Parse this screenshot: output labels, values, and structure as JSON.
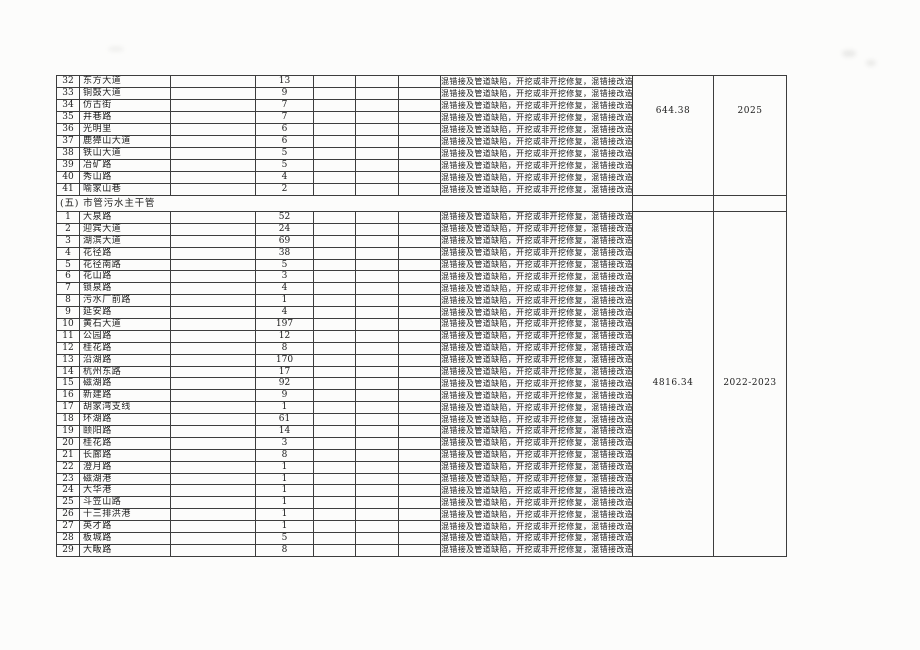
{
  "document": {
    "defect_text": "混错接及管道缺陷，开挖或非开挖修复，混错接改造",
    "sections": [
      {
        "id": "continuation-section",
        "header": null,
        "amount": "644.38",
        "years": "2025",
        "rows": [
          {
            "no": "32",
            "name": "东方大道",
            "qty": "13"
          },
          {
            "no": "33",
            "name": "铜鼓大道",
            "qty": "9"
          },
          {
            "no": "34",
            "name": "仿古街",
            "qty": "7"
          },
          {
            "no": "35",
            "name": "井巷路",
            "qty": "7"
          },
          {
            "no": "36",
            "name": "光明里",
            "qty": "6"
          },
          {
            "no": "37",
            "name": "鹿獐山大道",
            "qty": "6"
          },
          {
            "no": "38",
            "name": "铁山大道",
            "qty": "5"
          },
          {
            "no": "39",
            "name": "冶矿路",
            "qty": "5"
          },
          {
            "no": "40",
            "name": "秀山路",
            "qty": "4"
          },
          {
            "no": "41",
            "name": "喻家山巷",
            "qty": "2"
          }
        ]
      },
      {
        "id": "section-5",
        "header": "(五) 市管污水主干管",
        "amount": "4816.34",
        "years": "2022-2023",
        "rows": [
          {
            "no": "1",
            "name": "大泉路",
            "qty": "52"
          },
          {
            "no": "2",
            "name": "迎宾大道",
            "qty": "24"
          },
          {
            "no": "3",
            "name": "湖滨大道",
            "qty": "69"
          },
          {
            "no": "4",
            "name": "花径路",
            "qty": "38"
          },
          {
            "no": "5",
            "name": "花径南路",
            "qty": "5"
          },
          {
            "no": "6",
            "name": "花山路",
            "qty": "3"
          },
          {
            "no": "7",
            "name": "锁泉路",
            "qty": "4"
          },
          {
            "no": "8",
            "name": "污水厂前路",
            "qty": "1"
          },
          {
            "no": "9",
            "name": "延安路",
            "qty": "4"
          },
          {
            "no": "10",
            "name": "黄石大道",
            "qty": "197"
          },
          {
            "no": "11",
            "name": "公园路",
            "qty": "12"
          },
          {
            "no": "12",
            "name": "桂花路",
            "qty": "8"
          },
          {
            "no": "13",
            "name": "沿湖路",
            "qty": "170"
          },
          {
            "no": "14",
            "name": "杭州东路",
            "qty": "17"
          },
          {
            "no": "15",
            "name": "磁湖路",
            "qty": "92"
          },
          {
            "no": "16",
            "name": "新建路",
            "qty": "9"
          },
          {
            "no": "17",
            "name": "胡家湾支线",
            "qty": "1"
          },
          {
            "no": "18",
            "name": "环湖路",
            "qty": "61"
          },
          {
            "no": "19",
            "name": "颐阳路",
            "qty": "14"
          },
          {
            "no": "20",
            "name": "桂花路",
            "qty": "3"
          },
          {
            "no": "21",
            "name": "长廊路",
            "qty": "8"
          },
          {
            "no": "22",
            "name": "澄月路",
            "qty": "1"
          },
          {
            "no": "23",
            "name": "磁湖港",
            "qty": "1"
          },
          {
            "no": "24",
            "name": "大华港",
            "qty": "1"
          },
          {
            "no": "25",
            "name": "斗笠山路",
            "qty": "1"
          },
          {
            "no": "26",
            "name": "十三排洪港",
            "qty": "1"
          },
          {
            "no": "27",
            "name": "英才路",
            "qty": "1"
          },
          {
            "no": "28",
            "name": "板城路",
            "qty": "5"
          },
          {
            "no": "29",
            "name": "大畈路",
            "qty": "8"
          }
        ]
      }
    ]
  }
}
